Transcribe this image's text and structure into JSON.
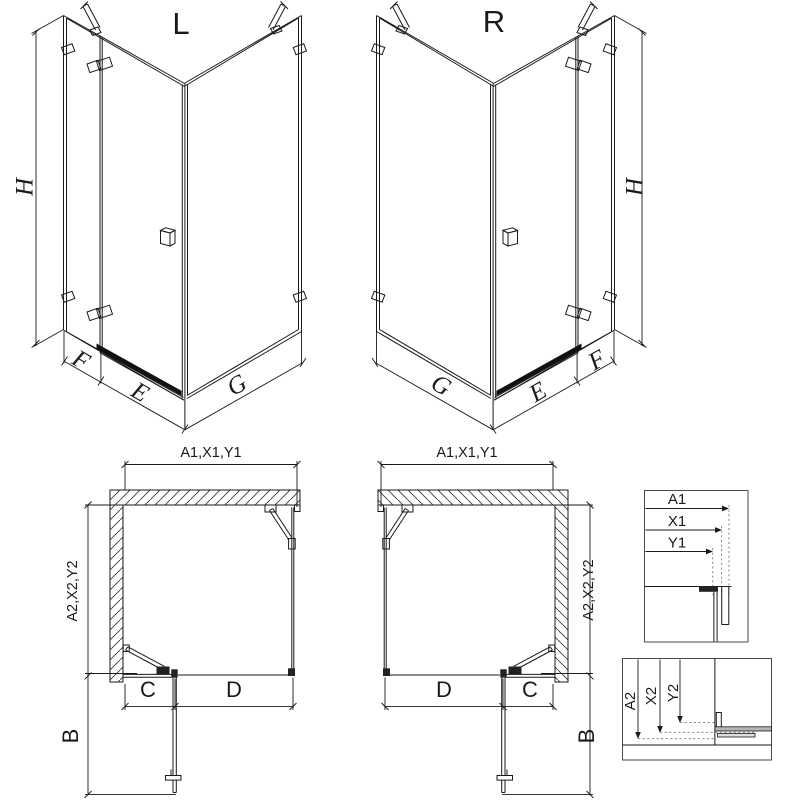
{
  "drawing": {
    "line_color": "#1a1a1a",
    "background": "#ffffff",
    "iso_left": {
      "variant": "L",
      "height": "H",
      "fixed_width": "F",
      "door_width": "E",
      "side_width": "G"
    },
    "iso_right": {
      "variant": "R",
      "height": "H",
      "fixed_width": "F",
      "door_width": "E",
      "side_width": "G"
    },
    "plan_left": {
      "width_dim": "A1,X1,Y1",
      "depth_dim": "A2,X2,Y2",
      "fixed_dim": "C",
      "door_dim": "D",
      "open_dim": "B"
    },
    "plan_right": {
      "width_dim": "A1,X1,Y1",
      "depth_dim": "A2,X2,Y2",
      "fixed_dim": "C",
      "door_dim": "D",
      "open_dim": "B"
    },
    "detail_width": {
      "labels": [
        "A1",
        "X1",
        "Y1"
      ]
    },
    "detail_depth": {
      "labels": [
        "A2",
        "X2",
        "Y2"
      ]
    }
  }
}
